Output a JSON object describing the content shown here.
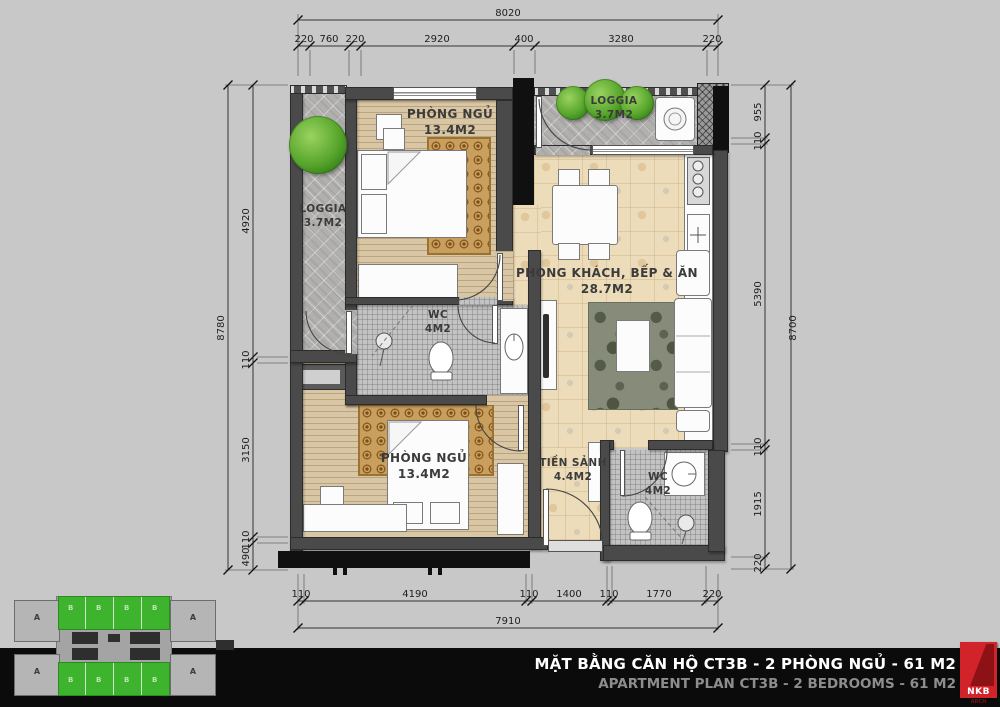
{
  "dimensions": {
    "top": {
      "total": "8020",
      "segments": [
        "220",
        "760",
        "220",
        "2920",
        "400",
        "3280",
        "220"
      ]
    },
    "bottom": {
      "total": "7910",
      "segments": [
        "110",
        "4190",
        "110",
        "1400",
        "110",
        "1770",
        "220"
      ]
    },
    "left": {
      "total": "8780",
      "segments": [
        "4920",
        "110",
        "3150",
        "110",
        "490"
      ]
    },
    "right": {
      "total": "8700",
      "segments": [
        "955",
        "110",
        "5390",
        "110",
        "1915",
        "220"
      ]
    }
  },
  "rooms": {
    "bedroom1": {
      "name": "PHÒNG NGỦ",
      "area": "13.4M2"
    },
    "loggia1": {
      "name": "LOGGIA",
      "area": "3.7M2"
    },
    "loggia2": {
      "name": "LOGGIA",
      "area": "3.7M2"
    },
    "living": {
      "name": "PHÒNG KHÁCH, BẾP & ĂN",
      "area": "28.7M2"
    },
    "wc1": {
      "name": "WC",
      "area": "4M2"
    },
    "bedroom2": {
      "name": "PHÒNG NGỦ",
      "area": "13.4M2"
    },
    "hall": {
      "name": "TIỀN SẢNH",
      "area": "4.4M2"
    },
    "wc2": {
      "name": "WC",
      "area": "4M2"
    }
  },
  "title_bar": {
    "line1": "MẶT BẰNG CĂN HỘ CT3B - 2 PHÒNG NGỦ - 61 M2",
    "line2": "APARTMENT PLAN CT3B - 2 BEDROOMS - 61 M2"
  },
  "logo": {
    "text": "NKB",
    "subtext": "ARCH"
  },
  "key_plan": {
    "unit_a": "A",
    "unit_b": "B"
  },
  "colors": {
    "wall": "#4a4a4a",
    "highlight_green": "#3db32e",
    "logo_red": "#d2232a",
    "wood_floor": "#d8c6a4",
    "tile_floor": "#ecdcba",
    "title_bg": "#0b0b0b"
  }
}
